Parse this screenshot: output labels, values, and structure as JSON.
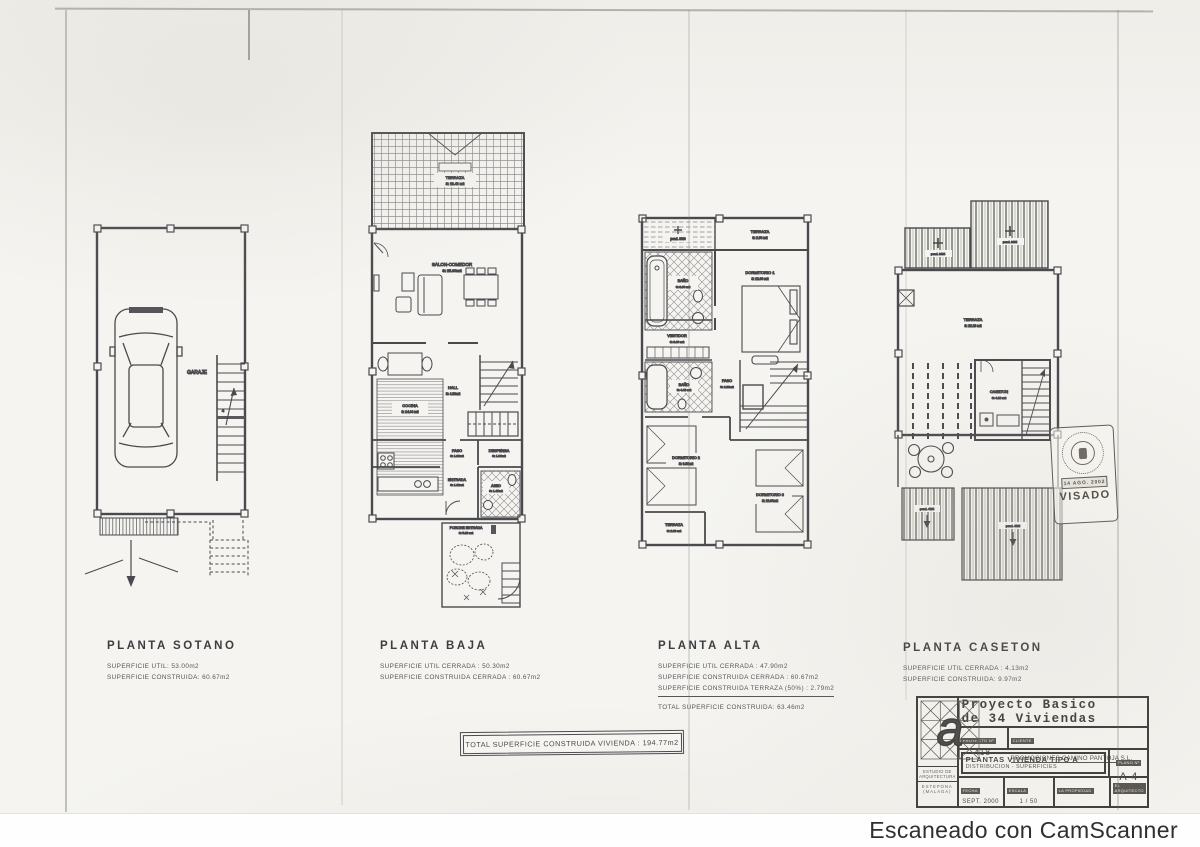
{
  "scanner_credit": "Escaneado con CamScanner",
  "plans": {
    "sotano": {
      "title": "PLANTA SOTANO",
      "areas": [
        "SUPERFICIE UTIL: 53.00m2",
        "SUPERFICIE CONSTRUIDA: 60.67m2"
      ],
      "rooms": {
        "garaje": "GARAJE"
      }
    },
    "baja": {
      "title": "PLANTA BAJA",
      "areas": [
        "SUPERFICIE UTIL CERRADA : 50.30m2",
        "SUPERFICIE CONSTRUIDA CERRADA : 60.67m2"
      ],
      "rooms": {
        "terraza": "TERRAZA",
        "terraza_s": "S: 18.43 m2",
        "salon": "SALON-COMEDOR",
        "salon_s": "S: 25.00m2",
        "cocina": "COCINA",
        "cocina_s": "S: 14.04 m2",
        "hall": "HALL",
        "hall_s": "S: 4.20m2",
        "paso": "PASO",
        "paso_s": "S: 1.36m2",
        "despensa": "DESPENSA",
        "despensa_s": "S: 1.84m2",
        "entrada": "ENTRADA",
        "entrada_s": "S: 1.62m2",
        "aseo": "ASEO",
        "aseo_s": "S: 1.47m2",
        "porche": "PORCHE ENTRADA",
        "porche_s": "S: 5.18 m2"
      }
    },
    "alta": {
      "title": "PLANTA ALTA",
      "areas": [
        "SUPERFICIE UTIL CERRADA : 47.90m2",
        "SUPERFICIE CONSTRUIDA CERRADA : 60.67m2",
        "SUPERFICIE CONSTRUIDA TERRAZA (50%) : 2.79m2"
      ],
      "total": "TOTAL SUPERFICIE CONSTRUIDA: 63.46m2",
      "rooms": {
        "pend": "pend. 30%",
        "terraza1": "TERRAZA",
        "terraza1_s": "S: 2.54 m2",
        "bano1": "BAÑO",
        "bano1_s": "S: 3.66 m2",
        "dorm1": "DORMITORIO 1",
        "dorm1_s": "S: 12.00 m2",
        "vestidor": "VESTIDOR",
        "vestidor_s": "S: 3.60 m2",
        "bano2": "BAÑO",
        "bano2_s": "S: 4.43 m2",
        "paso": "PASO",
        "paso_s": "S: 2.86m2",
        "dorm2": "DORMITORIO 2",
        "dorm2_s": "S: 9.38m2",
        "dorm3": "DORMITORIO 3",
        "dorm3_s": "S: 10.00m2",
        "terraza2": "TERRAZA",
        "terraza2_s": "S: 2.20 m2"
      }
    },
    "caseton": {
      "title": "PLANTA CASETON",
      "areas": [
        "SUPERFICIE UTIL CERRADA : 4.13m2",
        "SUPERFICIE CONSTRUIDA: 9.97m2"
      ],
      "rooms": {
        "pend_top1": "pend. 30%",
        "pend_top2": "pend. 30%",
        "terraza": "TERRAZA",
        "terraza_s": "S: 22.23 m2",
        "caseton": "CASETON",
        "caseton_s": "S: 4.13 m2",
        "pend_bot1": "pend. 40%",
        "pend_bot2": "pend. 40%"
      }
    }
  },
  "total_box": "TOTAL SUPERFICIE CONSTRUIDA VIVIENDA :   194.77m2",
  "stamp": {
    "visado": "VISADO",
    "date": "14 AGO. 2002"
  },
  "title_block": {
    "title_line1": "Proyecto Basico",
    "title_line2": "de 34 Viviendas",
    "subtitle": "en Camino \"JUAN BENITEZ\" UCN-PA2 ESTEPONA -MALAGA-",
    "proyecto_label": "PROYECTO Nº",
    "proyecto_value": "418",
    "cliente_label": "CLIENTE",
    "cliente_value": "PROMOCIONES CAMINO PANTOJA S.L.",
    "plano_line1": "PLANTAS VIVIENDA  TIPO A",
    "plano_line2": "DISTRIBUCION - SUPERFICIES",
    "plano_num_label": "PLANO Nº",
    "plano_num_value": "A 4",
    "fecha_label": "FECHA",
    "fecha_value": "SEPT. 2000",
    "escala_label": "ESCALA",
    "escala_value": "1 / 50",
    "propiedad_label": "LA PROPIEDAD",
    "arquitecto_label": "EL ARQUITECTO",
    "studio_line1": "ESTUDIO DE ARQUITECTURA",
    "studio_line2": "ESTEPONA (MALAGA)"
  }
}
